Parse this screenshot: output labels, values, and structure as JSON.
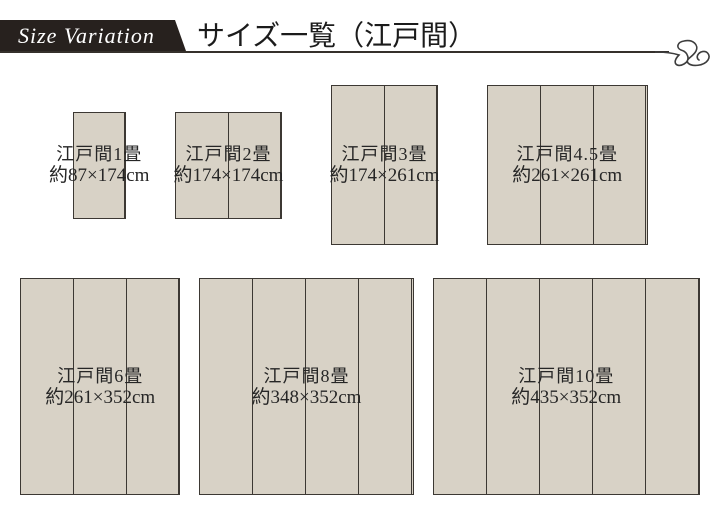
{
  "header": {
    "badge": "Size Variation",
    "title": "サイズ一覧（江戸間）"
  },
  "mats": [
    {
      "label": "江戸間1畳",
      "dimensions": "約87×174cm",
      "width_cm": 87,
      "height_cm": 174,
      "panels": 1,
      "row": 1
    },
    {
      "label": "江戸間2畳",
      "dimensions": "約174×174cm",
      "width_cm": 174,
      "height_cm": 174,
      "panels": 2,
      "row": 1
    },
    {
      "label": "江戸間3畳",
      "dimensions": "約174×261cm",
      "width_cm": 174,
      "height_cm": 261,
      "panels": 2,
      "row": 1
    },
    {
      "label": "江戸間4.5畳",
      "dimensions": "約261×261cm",
      "width_cm": 261,
      "height_cm": 261,
      "panels": 3,
      "row": 1
    },
    {
      "label": "江戸間6畳",
      "dimensions": "約261×352cm",
      "width_cm": 261,
      "height_cm": 352,
      "panels": 3,
      "row": 2
    },
    {
      "label": "江戸間8畳",
      "dimensions": "約348×352cm",
      "width_cm": 348,
      "height_cm": 352,
      "panels": 4,
      "row": 2
    },
    {
      "label": "江戸間10畳",
      "dimensions": "約435×352cm",
      "width_cm": 435,
      "height_cm": 352,
      "panels": 5,
      "row": 2
    }
  ],
  "colors": {
    "badge_bg": "#27211e",
    "mat_fill": "#d8d2c6",
    "mat_border": "#3c3833",
    "ink": "#262626",
    "rule": "#35302b"
  }
}
